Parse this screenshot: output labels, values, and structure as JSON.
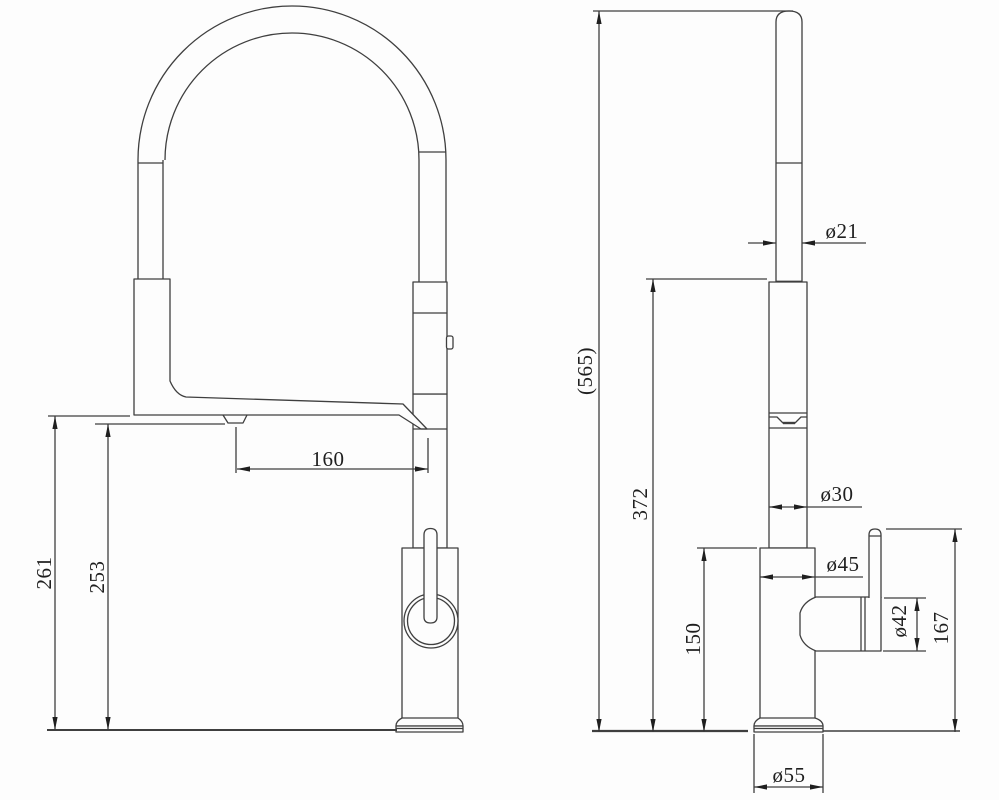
{
  "drawing": {
    "type": "kitchen-faucet-technical-drawing",
    "colors": {
      "line": "#3f3f3f",
      "text": "#1f1f1f",
      "background": "#fdfdfd"
    }
  },
  "dimensions": {
    "front": {
      "height_to_spout": "261",
      "height_to_aerator": "253",
      "reach": "160"
    },
    "side": {
      "overall_height": "(565)",
      "head_height": "372",
      "body_height": "150",
      "hose_dia": "ø21",
      "column_dia": "ø30",
      "body_dia": "ø45",
      "handle_dia": "ø42",
      "handle_height": "167",
      "base_dia": "ø55"
    }
  }
}
